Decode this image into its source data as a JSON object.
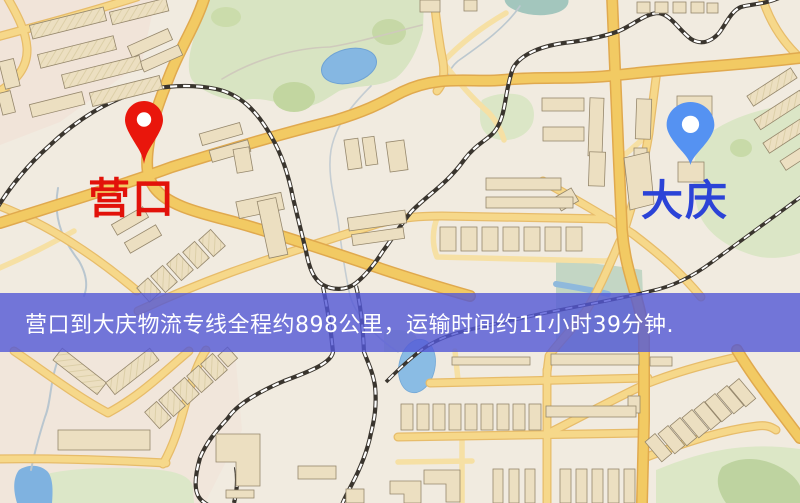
{
  "map": {
    "origin_label": "营口",
    "destination_label": "大庆",
    "origin_color": "#e2120a",
    "destination_color": "#2b43d7",
    "origin_pin_color": "#e9160c",
    "destination_pin_color": "#5592f2",
    "feature_colors": {
      "road_major": "#f2ca63",
      "road_minor": "#f6e0a4",
      "park_green": "#d8e4c2",
      "water_blue": "#85b7e2",
      "railway_dark": "#3a352e",
      "building_beige": "#ecdfc1"
    }
  },
  "banner": {
    "text": "营口到大庆物流专线全程约898公里，运输时间约11小时39分钟.",
    "background": "rgba(82,88,214,0.8)",
    "text_color": "#ffffff"
  }
}
